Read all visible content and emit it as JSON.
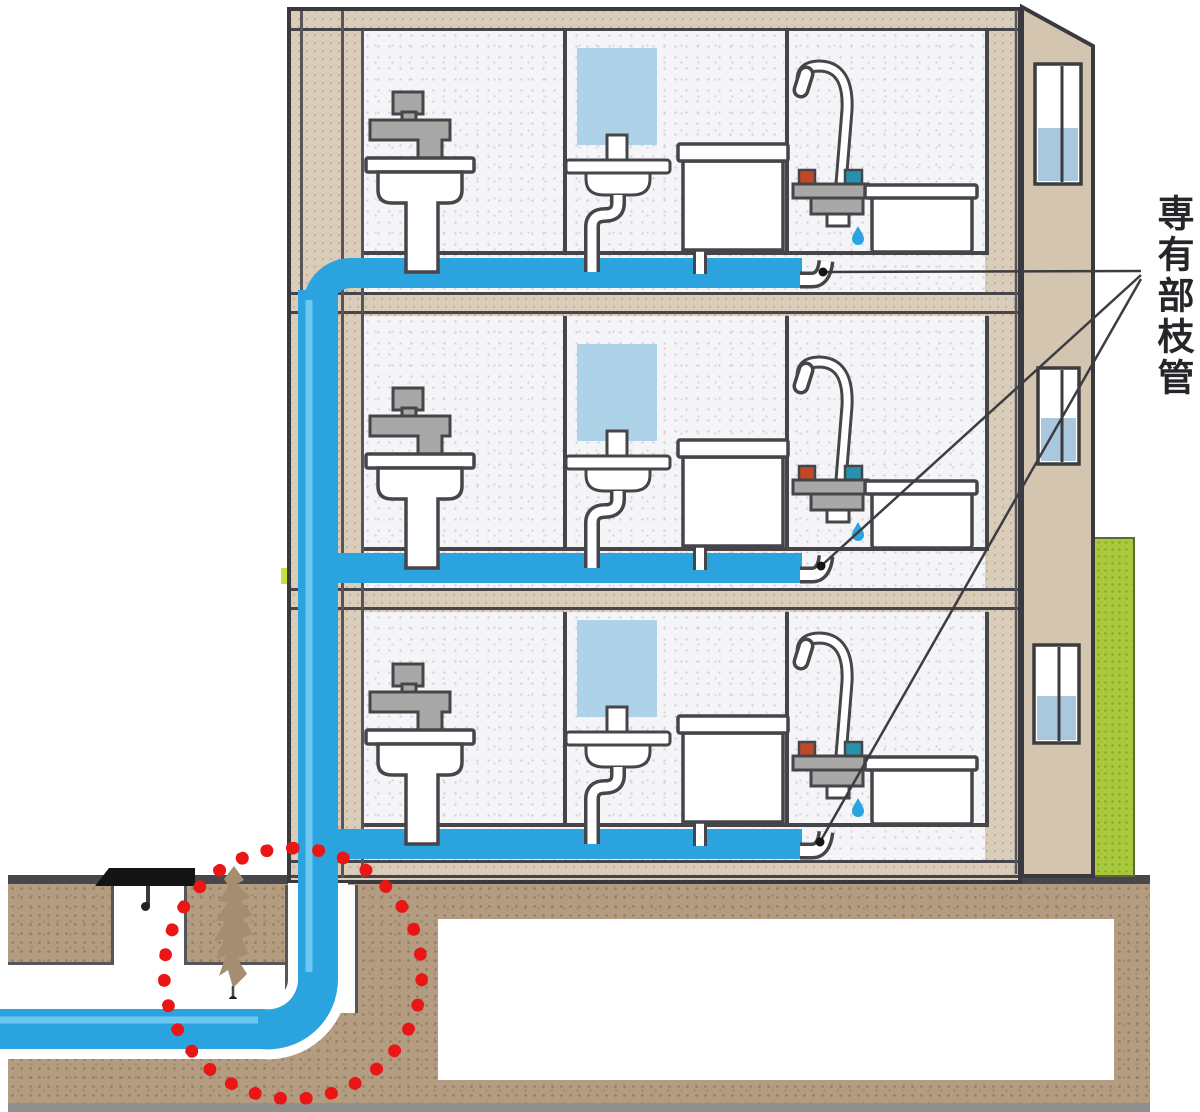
{
  "annotation": {
    "label": "専有部枝管",
    "leader_targets": [
      "third-floor-branch-end",
      "second-floor-branch-end",
      "first-floor-branch-end"
    ]
  },
  "colors": {
    "pipe": "#2aa3de",
    "pipehl": "#6cc8f0",
    "beige": "#d9ccb8",
    "beigedark": "#d3c5af",
    "outline": "#45454a",
    "ground": "#46464c",
    "soil": "#b49c80",
    "red": "#ea1515",
    "mirror": "#aed2e8",
    "glass": "#a9c8de",
    "green": "#a9c93c",
    "hot": "#c04828",
    "cold": "#2792ac",
    "gray": "#a8a8a6",
    "ink": "#3c3c42"
  },
  "building": {
    "floors": [
      {
        "name": "third-floor",
        "fixtures": [
          "kitchen-faucet",
          "kitchen-sink",
          "mirror",
          "washbasin",
          "toilet",
          "shower-mixer",
          "bathtub"
        ]
      },
      {
        "name": "second-floor",
        "fixtures": [
          "kitchen-faucet",
          "kitchen-sink",
          "mirror",
          "washbasin",
          "toilet",
          "shower-mixer",
          "bathtub"
        ]
      },
      {
        "name": "first-floor",
        "fixtures": [
          "kitchen-faucet",
          "kitchen-sink",
          "mirror",
          "washbasin",
          "toilet",
          "shower-mixer",
          "bathtub"
        ]
      }
    ],
    "side_windows": 3
  },
  "underground": {
    "highlighted_area": "service-pipe-elbow",
    "highlight_style": "red-dotted-circle"
  }
}
